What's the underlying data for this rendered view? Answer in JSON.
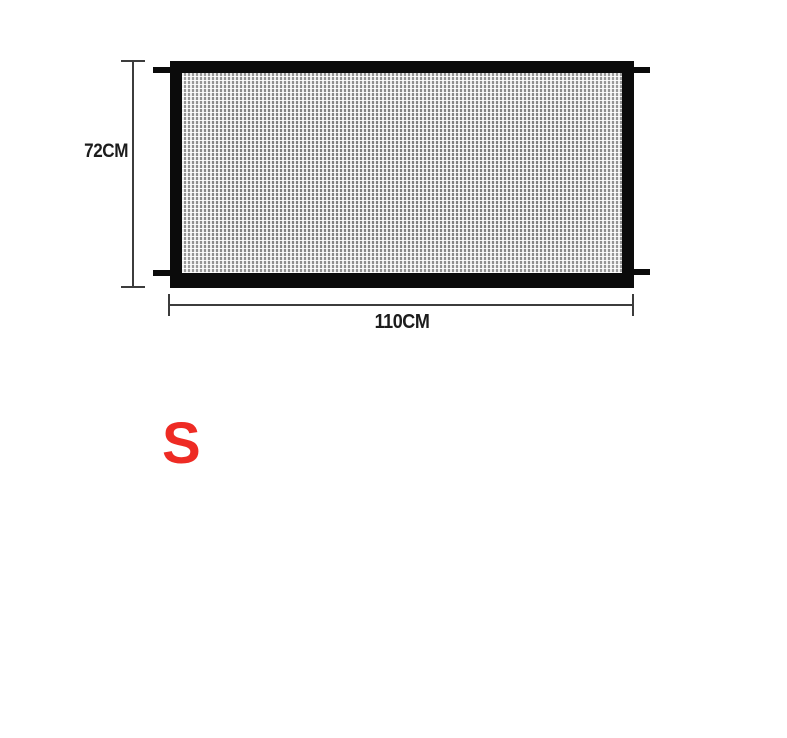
{
  "diagram": {
    "product": "mesh-gate",
    "height_dimension": {
      "label": "72CM"
    },
    "width_dimension": {
      "label": "110CM"
    },
    "size_option": {
      "label": "S"
    },
    "colors": {
      "background": "#ffffff",
      "gate_frame": "#0b0b0b",
      "mesh_fill": "#aeaeae",
      "dimension_line": "#3c3c3c",
      "dimension_text": "#1c1c1c",
      "size_label": "#ee2b24"
    }
  }
}
